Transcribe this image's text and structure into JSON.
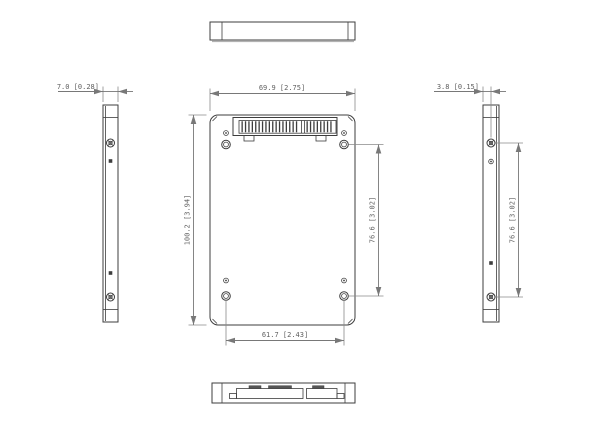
{
  "drawing": {
    "dimensions": {
      "thickness": "7.0 [0.28]",
      "width": "69.9 [2.75]",
      "hole_offset": "3.8 [0.15]",
      "height": "100.2 [3.94]",
      "front_hole_span": "76.6 [3.02]",
      "side_hole_span": "76.6 [3.02]",
      "bottom_hole_span": "61.7 [2.43]"
    },
    "colors": {
      "background": "#ffffff",
      "object_line": "#3d3d3d",
      "dimension_line": "#787878",
      "dimension_text": "#606060"
    }
  }
}
